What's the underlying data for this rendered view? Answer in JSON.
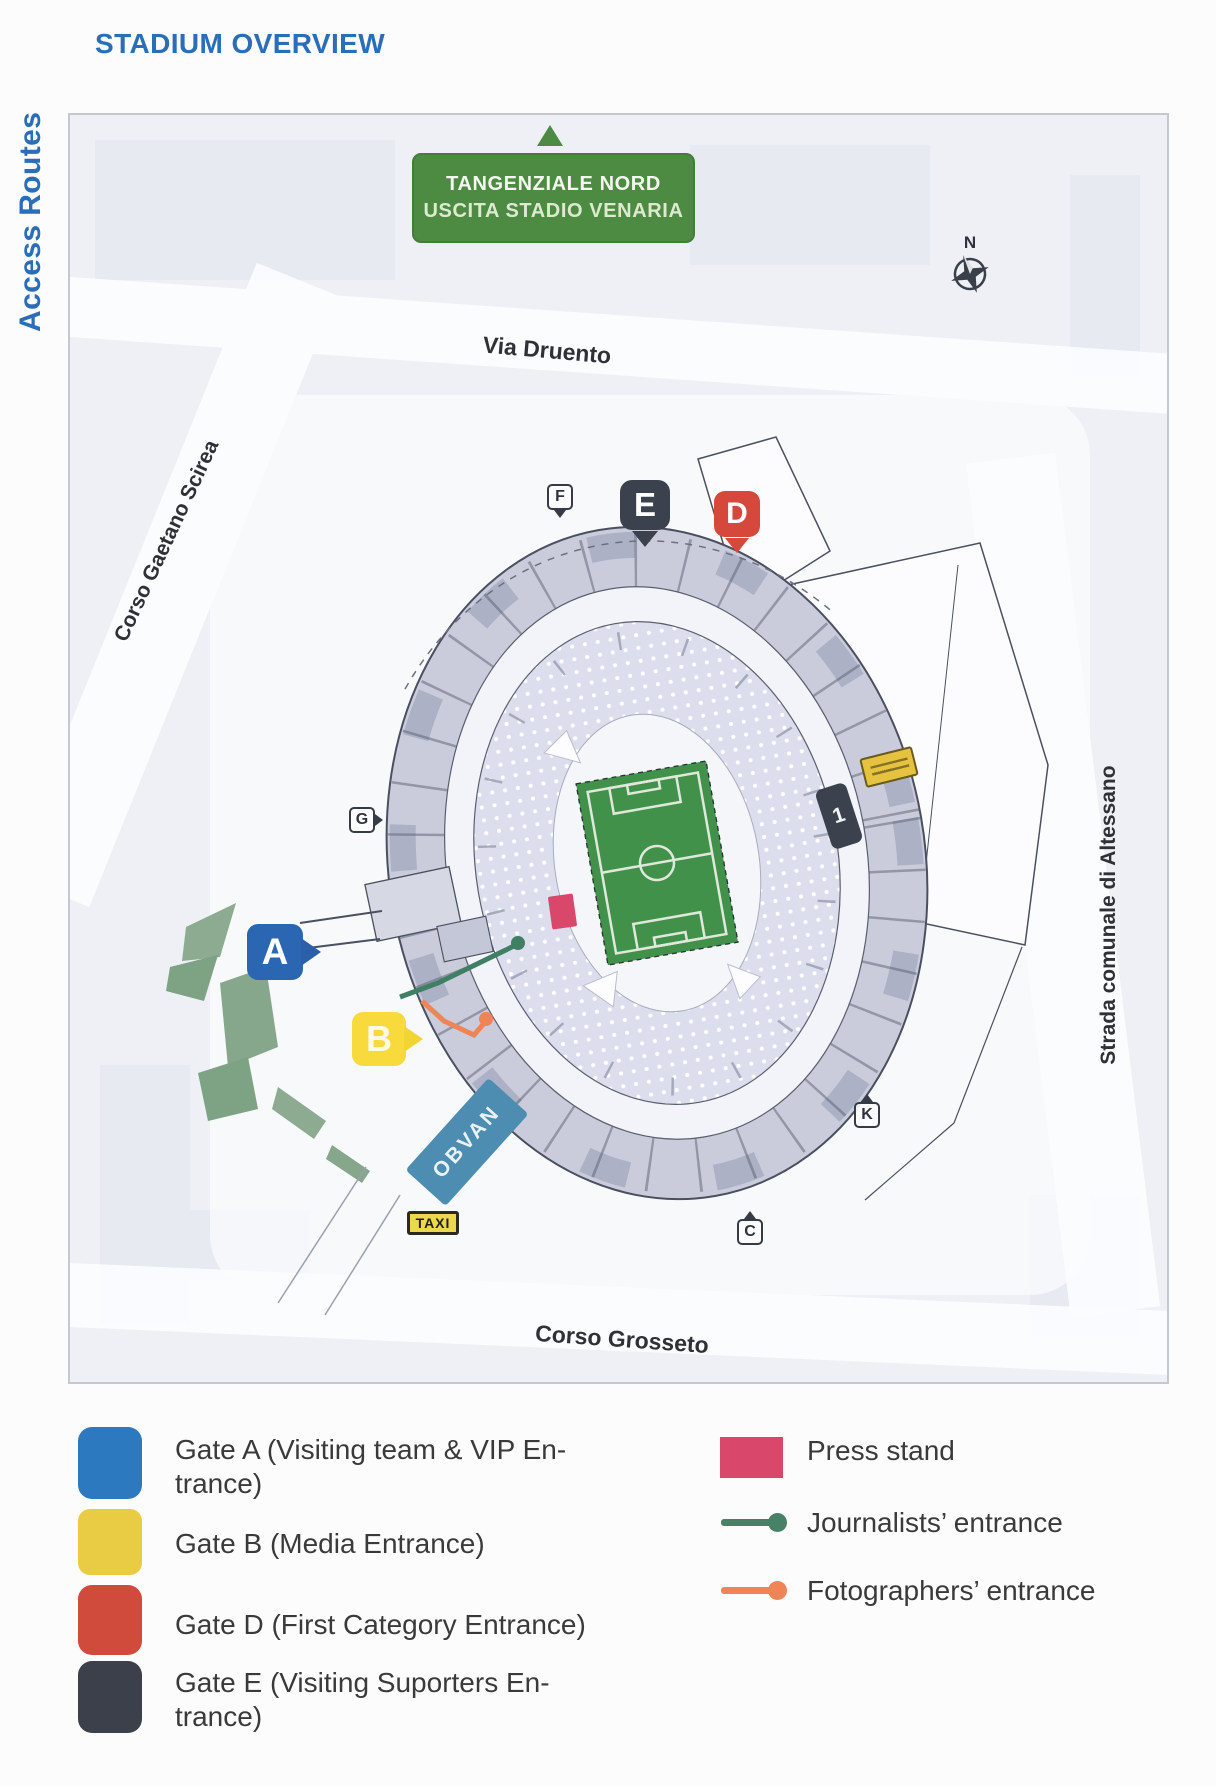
{
  "page": {
    "title": "STADIUM OVERVIEW",
    "side_label": "Access Routes"
  },
  "map": {
    "highway_sign": {
      "line1": "TANGENZIALE NORD",
      "line2": "USCITA STADIO VENARIA",
      "color": "#4d8a42"
    },
    "compass_label": "N",
    "streets": {
      "via_druento": "Via Druento",
      "corso_gaetano_scirea": "Corso Gaetano Scirea",
      "strada_comunale": "Strada comunale di Altessano",
      "corso_grosseto": "Corso Grosseto"
    },
    "gate_pins": [
      {
        "letter": "A",
        "color": "#2b66b2"
      },
      {
        "letter": "B",
        "color": "#f8da3c"
      },
      {
        "letter": "D",
        "color": "#d6483b"
      },
      {
        "letter": "E",
        "color": "#3b414d"
      }
    ],
    "poi_markers": [
      {
        "letter": "F"
      },
      {
        "letter": "G"
      },
      {
        "letter": "K"
      },
      {
        "letter": "C"
      }
    ],
    "tower_label": "1",
    "obvan_label": "OBVAN",
    "taxi_label": "TAXI",
    "pitch_color": "#41914b"
  },
  "legend": {
    "gates": [
      {
        "color": "#2d79bf",
        "lines": [
          "Gate A (Visiting team  & VIP En-",
          "trance)"
        ]
      },
      {
        "color": "#e9cc43",
        "lines": [
          "Gate B (Media Entrance)"
        ]
      },
      {
        "color": "#d04b3c",
        "lines": [
          "Gate D (First Category Entrance)"
        ]
      },
      {
        "color": "#3b404b",
        "lines": [
          "Gate E (Visiting Suporters En-",
          "trance)"
        ]
      }
    ],
    "media": [
      {
        "color": "#d9486b",
        "label": "Press stand"
      },
      {
        "color": "#478266",
        "label": "Journalists’ entrance"
      },
      {
        "color": "#ef8456",
        "label": "Fotographers’ entrance"
      }
    ]
  }
}
